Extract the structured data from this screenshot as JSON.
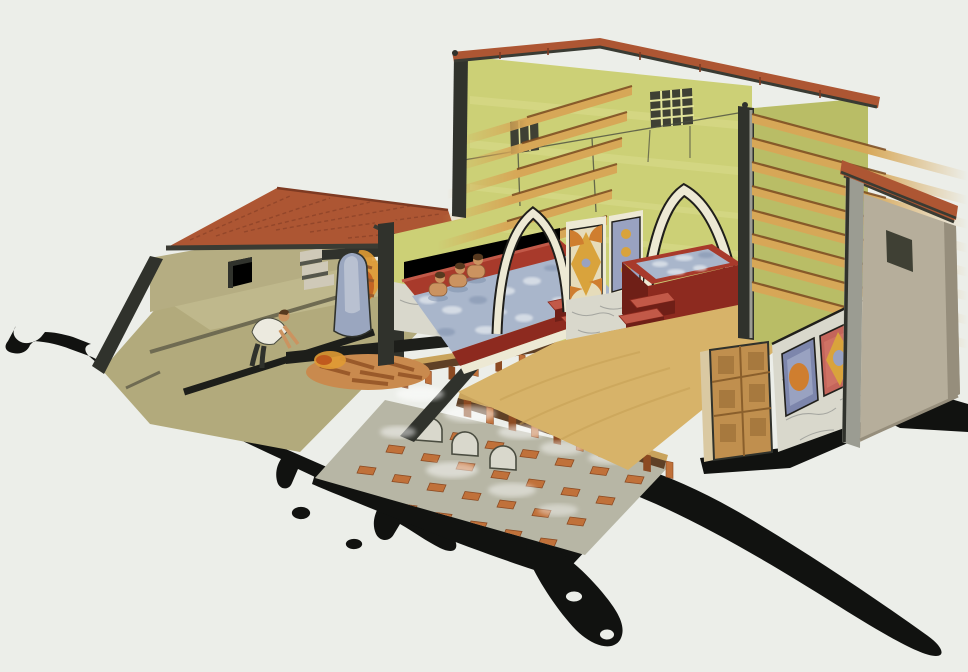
{
  "scene": {
    "title": "Cutaway watercolour illustration of a Roman bath house: furnace room with stoker and boiler, two arched alcoves with red-rimmed plunge pools (three bathers in the left pool), tiled roofs, cut ceiling beams, decorated wall panels, and the hypocaust under-floor heating with brick pilae and steam; black cut-earth shadow spreads around the base",
    "bather_count": 3,
    "arch_count": 2,
    "pool_count": 2
  },
  "palette": {
    "bg": "#eceee9",
    "shadow": "#111210",
    "cutDark": "#30322c",
    "cutDarker": "#1d1e1a",
    "roofTile": "#ad5633",
    "roofTileDark": "#7e3a22",
    "eave": "#3a3b33",
    "wallKhaki": "#b5ad82",
    "floorKhaki": "#b2aa7c",
    "floorKhakiLight": "#c5be93",
    "stepLine": "#6f6b52",
    "interiorWall": "#ccd076",
    "interiorWallShade": "#b9bd66",
    "interiorWallLight": "#e2e39a",
    "beamWood": "#d7a757",
    "beamEdge": "#7a4a20",
    "windowDark": "#3f4034",
    "outline": "#4a4c40",
    "archCream": "#ede9d4",
    "inkBlack": "#201f1b",
    "poolRed": "#a83a2b",
    "poolRedLight": "#c25948",
    "poolRedDark": "#8d2a1f",
    "poolRedDeep": "#6f1f17",
    "water": "#a9b6cb",
    "waterLight": "#e3e8ee",
    "waterShade": "#7c8daa",
    "skin": "#cb9360",
    "hair": "#57391f",
    "tunic": "#eceadf",
    "marble": "#d9d8cc",
    "marbleVein": "#a5a6a0",
    "panelCream": "#e6dcba",
    "panelGold": "#d9a33c",
    "panelOrange": "#cf7e2f",
    "panelBlue": "#99a2c1",
    "panelBlueDeep": "#7d86ac",
    "panelRedFrame": "#c4655b",
    "panelRedFill": "#cf7264",
    "floorSand": "#d7b369",
    "floorSandDark": "#c59f53",
    "hypoGrey": "#b7b6a5",
    "brick": "#c0713a",
    "brickDark": "#8c4a22",
    "slabDark": "#5f4026",
    "slabTan": "#c9a35c",
    "steamWhite": "#ffffff",
    "doorWood": "#c08f4e",
    "doorWoodDark": "#8a5f2c",
    "doorJamb": "#dac9a2",
    "annexWall": "#b6ae9b",
    "annexShade": "#968e7c",
    "pillarGrey": "#9b9c92",
    "boiler": "#9aa6bf",
    "boilerLight": "#c6cdd9",
    "flame": "#e09a34",
    "flameDeep": "#c05a1e",
    "log": "#9a5a2a",
    "logLight": "#c98a4e",
    "stair": "#cfc9b8",
    "stairDark": "#55564c"
  },
  "generate": {
    "beamsLeft": {
      "count": 6,
      "ax": 632,
      "ay0": 86,
      "ayStep": 26,
      "axStep": -5,
      "len": 175,
      "drop": 52,
      "thick": 9
    },
    "beamsRight": {
      "count": 8,
      "ax": 752,
      "ay0": 114,
      "ayStep": 24,
      "axStep": 0,
      "len": 216,
      "drop": 58,
      "thick": 9
    },
    "hypoGrid": {
      "rows": 5,
      "cols": 7,
      "ox": 418,
      "oy": 424,
      "colDx": 35,
      "colDy": 8.5,
      "rowDx": -29,
      "rowDy": 21,
      "w": 16,
      "h": 7
    },
    "stubsMain": {
      "x0": 464,
      "y0": 400,
      "x1": 666,
      "y1": 461,
      "count": 10,
      "w": 7,
      "h": 16
    },
    "stubsUpper": {
      "x0": 402,
      "y0": 374,
      "x1": 566,
      "y1": 346,
      "count": 8,
      "w": 6,
      "h": 13
    },
    "steam": [
      [
        420,
        394,
        24,
        7,
        0.55
      ],
      [
        470,
        414,
        26,
        8,
        0.5
      ],
      [
        522,
        432,
        24,
        7,
        0.5
      ],
      [
        562,
        448,
        22,
        7,
        0.45
      ],
      [
        608,
        458,
        20,
        6,
        0.45
      ],
      [
        452,
        470,
        26,
        8,
        0.5
      ],
      [
        512,
        490,
        24,
        7,
        0.45
      ],
      [
        558,
        510,
        20,
        6,
        0.4
      ],
      [
        398,
        432,
        18,
        6,
        0.5
      ],
      [
        610,
        432,
        16,
        5,
        0.4
      ],
      [
        388,
        356,
        14,
        5,
        0.45
      ]
    ],
    "bathers": [
      [
        438,
        291
      ],
      [
        458,
        282
      ],
      [
        476,
        273
      ]
    ],
    "stepsLeft": {
      "ox": 548,
      "oy": 302,
      "dx": 13,
      "dy": 15,
      "w": 42,
      "slope": -0.22,
      "fh": 12,
      "count": 3
    },
    "stepsRight": {
      "ox": 630,
      "oy": 300,
      "dx": -11,
      "dy": 16,
      "w": 38,
      "slope": -0.2,
      "fh": 13,
      "count": 3
    },
    "waterBlobsLeft": [
      [
        428,
        300,
        9,
        4
      ],
      [
        452,
        310,
        10,
        4
      ],
      [
        478,
        300,
        9,
        4
      ],
      [
        505,
        291,
        10,
        4
      ],
      [
        532,
        281,
        9,
        4
      ],
      [
        552,
        268,
        8,
        3
      ],
      [
        486,
        330,
        11,
        4
      ],
      [
        524,
        318,
        9,
        4
      ],
      [
        446,
        332,
        9,
        4
      ],
      [
        560,
        300,
        8,
        3
      ],
      [
        500,
        312,
        7,
        3
      ]
    ],
    "waterBlobsRight": [
      [
        660,
        264,
        8,
        3
      ],
      [
        684,
        258,
        9,
        3
      ],
      [
        706,
        255,
        8,
        3
      ],
      [
        676,
        272,
        9,
        3
      ],
      [
        700,
        268,
        7,
        3
      ]
    ]
  }
}
